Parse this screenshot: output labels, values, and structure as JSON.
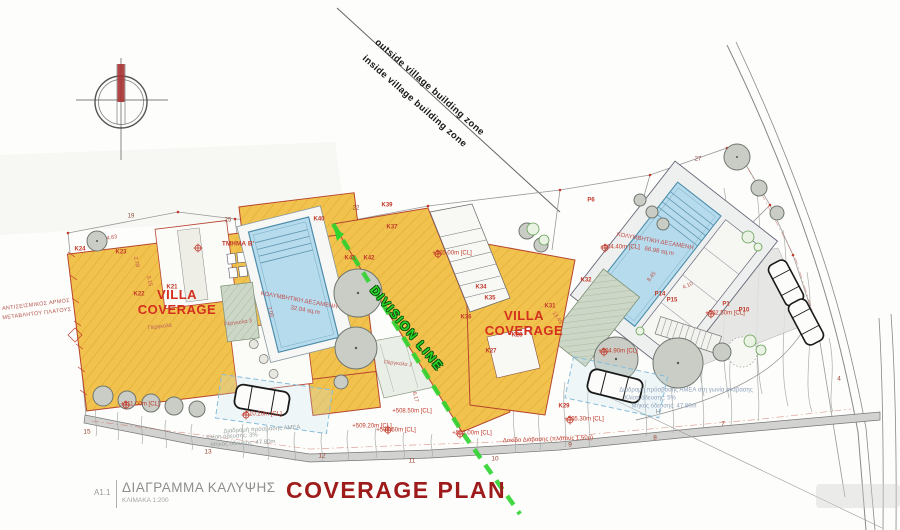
{
  "colors": {
    "villa_fill": "#F2C24E",
    "villa_outline": "#B5452F",
    "pool_fill": "#B6DBEC",
    "division_green": "#2FD42F",
    "annotation_red": "#C0392B",
    "title_red": "#9E1B1B",
    "drawing_gray": "#9AA0A0"
  },
  "zone": {
    "outside": "outside village building zone",
    "inside": "inside village building zone"
  },
  "villa_coverage_label": "VILLA\nCOVERAGE",
  "division_label": "DIVISION LINE",
  "pools": [
    {
      "name": "ΚΟΛΥΜΒΗΤΙΚΗ ΔΕΞΑΜΕΝΗ",
      "area": "32.04 sq.m"
    },
    {
      "name": "ΚΟΛΥΜΒΗΤΙΚΗ ΔΕΞΑΜΕΝΗ",
      "area": "66.98 sq.m"
    }
  ],
  "title_block": {
    "sheet_no": "A1.1",
    "title_el": "ΔΙΑΓΡΑΜΜΑ ΚΑΛΥΨΗΣ",
    "scale": "ΚΛΙΜΑΚΑ 1:200",
    "title_en": "COVERAGE PLAN"
  },
  "labels": [
    {
      "t": "K24",
      "x": 80,
      "y": 250,
      "r": 0,
      "c": "k"
    },
    {
      "t": "K23",
      "x": 121,
      "y": 253,
      "r": 0,
      "c": "k"
    },
    {
      "t": "K22",
      "x": 139,
      "y": 295,
      "r": 0,
      "c": "k"
    },
    {
      "t": "K21",
      "x": 172,
      "y": 288,
      "r": 0,
      "c": "k"
    },
    {
      "t": "K40",
      "x": 319,
      "y": 220,
      "r": 0,
      "c": "k"
    },
    {
      "t": "K39",
      "x": 387,
      "y": 206,
      "r": 0,
      "c": "k"
    },
    {
      "t": "K37",
      "x": 392,
      "y": 228,
      "r": 0,
      "c": "k"
    },
    {
      "t": "K41",
      "x": 350,
      "y": 259,
      "r": 0,
      "c": "k"
    },
    {
      "t": "K42",
      "x": 369,
      "y": 259,
      "r": 0,
      "c": "k"
    },
    {
      "t": "K34",
      "x": 481,
      "y": 288,
      "r": 0,
      "c": "k"
    },
    {
      "t": "K35",
      "x": 490,
      "y": 299,
      "r": 0,
      "c": "k"
    },
    {
      "t": "K36",
      "x": 466,
      "y": 318,
      "r": 0,
      "c": "k"
    },
    {
      "t": "K31",
      "x": 550,
      "y": 307,
      "r": 0,
      "c": "k"
    },
    {
      "t": "K28",
      "x": 517,
      "y": 336,
      "r": 0,
      "c": "k"
    },
    {
      "t": "K27",
      "x": 491,
      "y": 352,
      "r": 0,
      "c": "k"
    },
    {
      "t": "K32",
      "x": 586,
      "y": 281,
      "r": 0,
      "c": "k"
    },
    {
      "t": "K29",
      "x": 564,
      "y": 407,
      "r": 0,
      "c": "k"
    },
    {
      "t": "P6",
      "x": 591,
      "y": 201,
      "r": 0,
      "c": "k"
    },
    {
      "t": "P14",
      "x": 660,
      "y": 295,
      "r": 0,
      "c": "k"
    },
    {
      "t": "P15",
      "x": 672,
      "y": 301,
      "r": 0,
      "c": "k"
    },
    {
      "t": "P1",
      "x": 726,
      "y": 305,
      "r": 0,
      "c": "k"
    },
    {
      "t": "P10",
      "x": 744,
      "y": 311,
      "r": 0,
      "c": "k"
    },
    {
      "t": "19",
      "x": 131,
      "y": 217,
      "r": 0,
      "c": "bnum"
    },
    {
      "t": "25",
      "x": 228,
      "y": 221,
      "r": 0,
      "c": "bnum"
    },
    {
      "t": "22",
      "x": 356,
      "y": 209,
      "r": 0,
      "c": "bnum"
    },
    {
      "t": "27",
      "x": 698,
      "y": 160,
      "r": 0,
      "c": "bnum"
    },
    {
      "t": "15",
      "x": 87,
      "y": 432,
      "r": 0,
      "c": "roadno"
    },
    {
      "t": "13",
      "x": 208,
      "y": 452,
      "r": 0,
      "c": "roadno"
    },
    {
      "t": "12",
      "x": 322,
      "y": 456,
      "r": 0,
      "c": "roadno"
    },
    {
      "t": "11",
      "x": 412,
      "y": 461,
      "r": 0,
      "c": "roadno"
    },
    {
      "t": "10",
      "x": 495,
      "y": 459,
      "r": 0,
      "c": "roadno"
    },
    {
      "t": "9",
      "x": 570,
      "y": 445,
      "r": 0,
      "c": "roadno"
    },
    {
      "t": "8",
      "x": 655,
      "y": 438,
      "r": 0,
      "c": "roadno"
    },
    {
      "t": "7",
      "x": 723,
      "y": 424,
      "r": 0,
      "c": "roadno"
    },
    {
      "t": "4",
      "x": 839,
      "y": 379,
      "r": 0,
      "c": "roadno"
    },
    {
      "t": "+511.00m [CL]",
      "x": 140,
      "y": 405,
      "r": 0,
      "c": "lvl"
    },
    {
      "t": "+510.20m [CL]",
      "x": 262,
      "y": 415,
      "r": 0,
      "c": "lvl"
    },
    {
      "t": "+509.20m [CL]",
      "x": 372,
      "y": 427,
      "r": 0,
      "c": "lvl"
    },
    {
      "t": "+508.50m [CL]",
      "x": 412,
      "y": 412,
      "r": 0,
      "c": "lvl"
    },
    {
      "t": "+508.50m [CL]",
      "x": 396,
      "y": 431,
      "r": 0,
      "c": "lvl"
    },
    {
      "t": "+507.00m [CL]",
      "x": 472,
      "y": 434,
      "r": 0,
      "c": "lvl"
    },
    {
      "t": "+505.30m [CL]",
      "x": 584,
      "y": 420,
      "r": 0,
      "c": "lvl"
    },
    {
      "t": "+504.90m [CL]",
      "x": 618,
      "y": 352,
      "r": 0,
      "c": "lvl"
    },
    {
      "t": "+502.50m [CL]",
      "x": 725,
      "y": 314,
      "r": 0,
      "c": "lvl"
    },
    {
      "t": "+504.40m [CL]",
      "x": 620,
      "y": 248,
      "r": 0,
      "c": "lvl"
    },
    {
      "t": "+505.00m [CL]",
      "x": 452,
      "y": 254,
      "r": 0,
      "c": "lvl"
    },
    {
      "t": "Δοκίδα Διάβασης (πλάτους 1,50μ)",
      "x": 548,
      "y": 440,
      "r": -2,
      "c": "lvl"
    },
    {
      "t": "Διαδρομή πρόσβασης ΑΜΕΑ στη γωνία ανάβασης",
      "x": 686,
      "y": 391,
      "r": 0,
      "c": "noteb"
    },
    {
      "t": "Κλίση όδευσης: 5%",
      "x": 650,
      "y": 399,
      "r": 0,
      "c": "noteb"
    },
    {
      "t": "Μήκος όδευσης: 47.80m",
      "x": 664,
      "y": 407,
      "r": 0,
      "c": "noteb"
    },
    {
      "t": "Διαδρομή πρόσβασης ΑΜΕΑ",
      "x": 262,
      "y": 430,
      "r": -3,
      "c": "noteg"
    },
    {
      "t": "Κλίση όδευσης: 3%",
      "x": 232,
      "y": 437,
      "r": -3,
      "c": "noteg"
    },
    {
      "t": "Μήκος όδευσης: 47.80m",
      "x": 243,
      "y": 444,
      "r": -3,
      "c": "noteg"
    },
    {
      "t": "Πέργκολα",
      "x": 160,
      "y": 327,
      "r": -7,
      "c": "tinyr"
    },
    {
      "t": "Πέργκολα 3",
      "x": 238,
      "y": 323,
      "r": -7,
      "c": "tinyr"
    },
    {
      "t": "Πέργκολα 2",
      "x": 398,
      "y": 364,
      "r": 6,
      "c": "tinyr"
    },
    {
      "t": "ΤΜΗΜΑ Β'",
      "x": 238,
      "y": 244,
      "r": 0,
      "c": "tmima"
    },
    {
      "t": "ΑΝΤΙΣΕΙΣΜΙΚΟΣ ΑΡΜΟΣ",
      "x": 36,
      "y": 305,
      "r": -7,
      "c": "side"
    },
    {
      "t": "ΜΕΤΑΒΛΗΤΟΥ ΠΛΑΤΟΥΣ",
      "x": 37,
      "y": 314,
      "r": -7,
      "c": "side"
    },
    {
      "t": "4.63",
      "x": 112,
      "y": 238,
      "r": -10,
      "c": "dim"
    },
    {
      "t": "2.78",
      "x": 136,
      "y": 262,
      "r": 78,
      "c": "dim"
    },
    {
      "t": "3.15",
      "x": 149,
      "y": 281,
      "r": 78,
      "c": "dim"
    },
    {
      "t": "7.00",
      "x": 270,
      "y": 312,
      "r": 72,
      "c": "dim"
    },
    {
      "t": "8.45",
      "x": 652,
      "y": 277,
      "r": -52,
      "c": "dim"
    },
    {
      "t": "4.10",
      "x": 688,
      "y": 286,
      "r": -25,
      "c": "dim"
    },
    {
      "t": "13.45",
      "x": 557,
      "y": 318,
      "r": 55,
      "c": "dim"
    },
    {
      "t": "6.17",
      "x": 415,
      "y": 397,
      "r": 75,
      "c": "dim"
    },
    {
      "t": "H",
      "x": 658,
      "y": 413,
      "r": 0,
      "c": "dimg"
    }
  ]
}
